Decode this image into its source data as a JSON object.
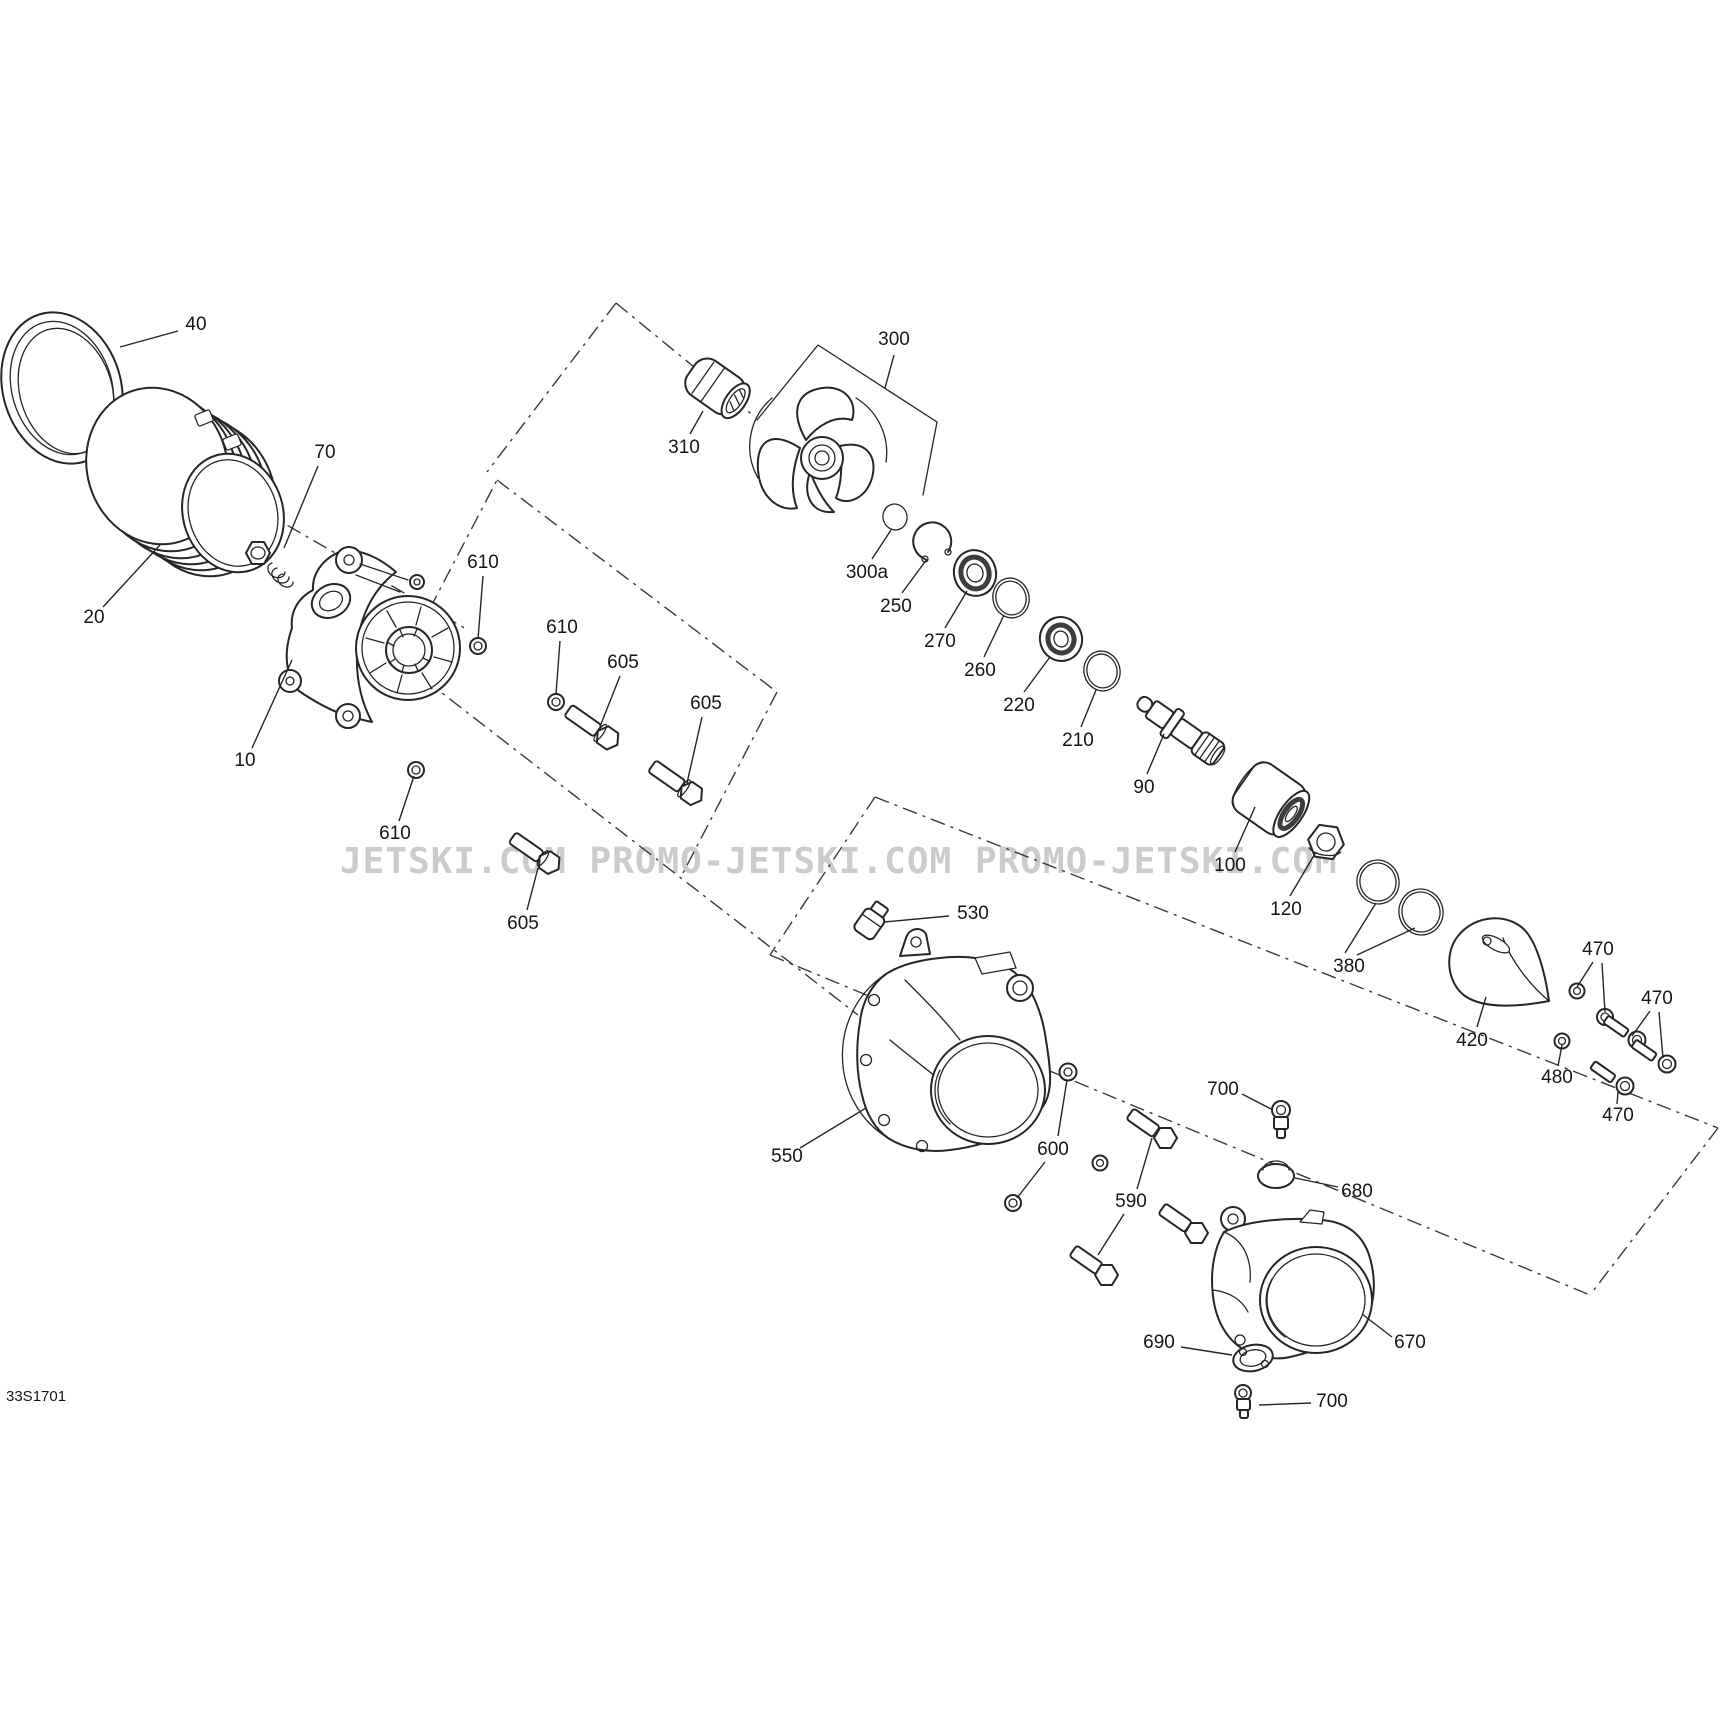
{
  "watermark": {
    "text": "JETSKI.COM  PROMO-JETSKI.COM  PROMO-JETSKI.COM",
    "color": "#c6c6c6"
  },
  "drawing_code": "33S1701",
  "diagram": {
    "type": "exploded-parts-diagram",
    "callouts": [
      {
        "ref": "40",
        "x": 196,
        "y": 325,
        "leaders": [
          [
            178,
            331,
            120,
            347
          ]
        ]
      },
      {
        "ref": "70",
        "x": 325,
        "y": 453,
        "leaders": [
          [
            318,
            466,
            284,
            548
          ]
        ]
      },
      {
        "ref": "20",
        "x": 94,
        "y": 618,
        "leaders": [
          [
            103,
            607,
            160,
            545
          ]
        ]
      },
      {
        "ref": "10",
        "x": 245,
        "y": 761,
        "leaders": [
          [
            252,
            748,
            292,
            660
          ]
        ]
      },
      {
        "ref": "610",
        "x": 483,
        "y": 563,
        "leaders": [
          [
            483,
            576,
            478,
            639
          ]
        ]
      },
      {
        "ref": "610",
        "x": 562,
        "y": 628,
        "leaders": [
          [
            560,
            641,
            556,
            694
          ]
        ]
      },
      {
        "ref": "605",
        "x": 623,
        "y": 663,
        "leaders": [
          [
            620,
            676,
            601,
            724
          ]
        ]
      },
      {
        "ref": "605",
        "x": 706,
        "y": 704,
        "leaders": [
          [
            702,
            717,
            687,
            783
          ]
        ]
      },
      {
        "ref": "610",
        "x": 395,
        "y": 834,
        "leaders": [
          [
            399,
            821,
            414,
            776
          ]
        ]
      },
      {
        "ref": "605",
        "x": 523,
        "y": 924,
        "leaders": [
          [
            527,
            910,
            538,
            868
          ]
        ]
      },
      {
        "ref": "300",
        "x": 894,
        "y": 340,
        "leaders": [
          [
            894,
            355,
            885,
            388
          ]
        ]
      },
      {
        "ref": "310",
        "x": 684,
        "y": 448,
        "leaders": [
          [
            690,
            434,
            703,
            411
          ]
        ]
      },
      {
        "ref": "300a",
        "x": 867,
        "y": 573,
        "leaders": [
          [
            872,
            559,
            891,
            530
          ]
        ]
      },
      {
        "ref": "250",
        "x": 896,
        "y": 607,
        "leaders": [
          [
            902,
            593,
            927,
            559
          ]
        ]
      },
      {
        "ref": "270",
        "x": 940,
        "y": 642,
        "leaders": [
          [
            945,
            628,
            967,
            591
          ]
        ]
      },
      {
        "ref": "260",
        "x": 980,
        "y": 671,
        "leaders": [
          [
            984,
            657,
            1004,
            615
          ]
        ]
      },
      {
        "ref": "220",
        "x": 1019,
        "y": 706,
        "leaders": [
          [
            1024,
            692,
            1050,
            657
          ]
        ]
      },
      {
        "ref": "210",
        "x": 1078,
        "y": 741,
        "leaders": [
          [
            1081,
            727,
            1096,
            690
          ]
        ]
      },
      {
        "ref": "90",
        "x": 1144,
        "y": 788,
        "leaders": [
          [
            1147,
            774,
            1164,
            734
          ]
        ]
      },
      {
        "ref": "100",
        "x": 1230,
        "y": 866,
        "leaders": [
          [
            1235,
            852,
            1255,
            807
          ]
        ]
      },
      {
        "ref": "120",
        "x": 1286,
        "y": 910,
        "leaders": [
          [
            1290,
            896,
            1316,
            852
          ]
        ]
      },
      {
        "ref": "380",
        "x": 1349,
        "y": 967,
        "leaders": [
          [
            1345,
            953,
            1376,
            903
          ],
          [
            1357,
            955,
            1415,
            928
          ]
        ]
      },
      {
        "ref": "420",
        "x": 1472,
        "y": 1041,
        "leaders": [
          [
            1477,
            1027,
            1486,
            997
          ]
        ]
      },
      {
        "ref": "470",
        "x": 1598,
        "y": 950,
        "leaders": [
          [
            1593,
            962,
            1577,
            987
          ],
          [
            1602,
            963,
            1605,
            1012
          ]
        ]
      },
      {
        "ref": "470",
        "x": 1657,
        "y": 999,
        "leaders": [
          [
            1650,
            1011,
            1632,
            1036
          ],
          [
            1659,
            1012,
            1663,
            1058
          ]
        ]
      },
      {
        "ref": "480",
        "x": 1557,
        "y": 1078,
        "leaders": [
          [
            1558,
            1066,
            1562,
            1045
          ]
        ]
      },
      {
        "ref": "470",
        "x": 1618,
        "y": 1116,
        "leaders": [
          [
            1617,
            1104,
            1618,
            1092
          ]
        ]
      },
      {
        "ref": "530",
        "x": 973,
        "y": 914,
        "leaders": [
          [
            949,
            916,
            884,
            922
          ]
        ]
      },
      {
        "ref": "550",
        "x": 787,
        "y": 1157,
        "leaders": [
          [
            800,
            1148,
            866,
            1108
          ]
        ]
      },
      {
        "ref": "600",
        "x": 1053,
        "y": 1150,
        "leaders": [
          [
            1058,
            1136,
            1067,
            1080
          ],
          [
            1045,
            1162,
            1017,
            1198
          ]
        ]
      },
      {
        "ref": "590",
        "x": 1131,
        "y": 1202,
        "leaders": [
          [
            1137,
            1189,
            1152,
            1138
          ],
          [
            1124,
            1214,
            1098,
            1255
          ]
        ]
      },
      {
        "ref": "700",
        "x": 1223,
        "y": 1090,
        "leaders": [
          [
            1242,
            1094,
            1273,
            1110
          ]
        ]
      },
      {
        "ref": "680",
        "x": 1357,
        "y": 1192,
        "leaders": [
          [
            1338,
            1187,
            1295,
            1178
          ]
        ]
      },
      {
        "ref": "670",
        "x": 1410,
        "y": 1343,
        "leaders": [
          [
            1392,
            1337,
            1362,
            1314
          ]
        ]
      },
      {
        "ref": "690",
        "x": 1159,
        "y": 1343,
        "leaders": [
          [
            1181,
            1347,
            1232,
            1355
          ]
        ]
      },
      {
        "ref": "700",
        "x": 1332,
        "y": 1402,
        "leaders": [
          [
            1311,
            1403,
            1259,
            1405
          ]
        ]
      }
    ]
  }
}
